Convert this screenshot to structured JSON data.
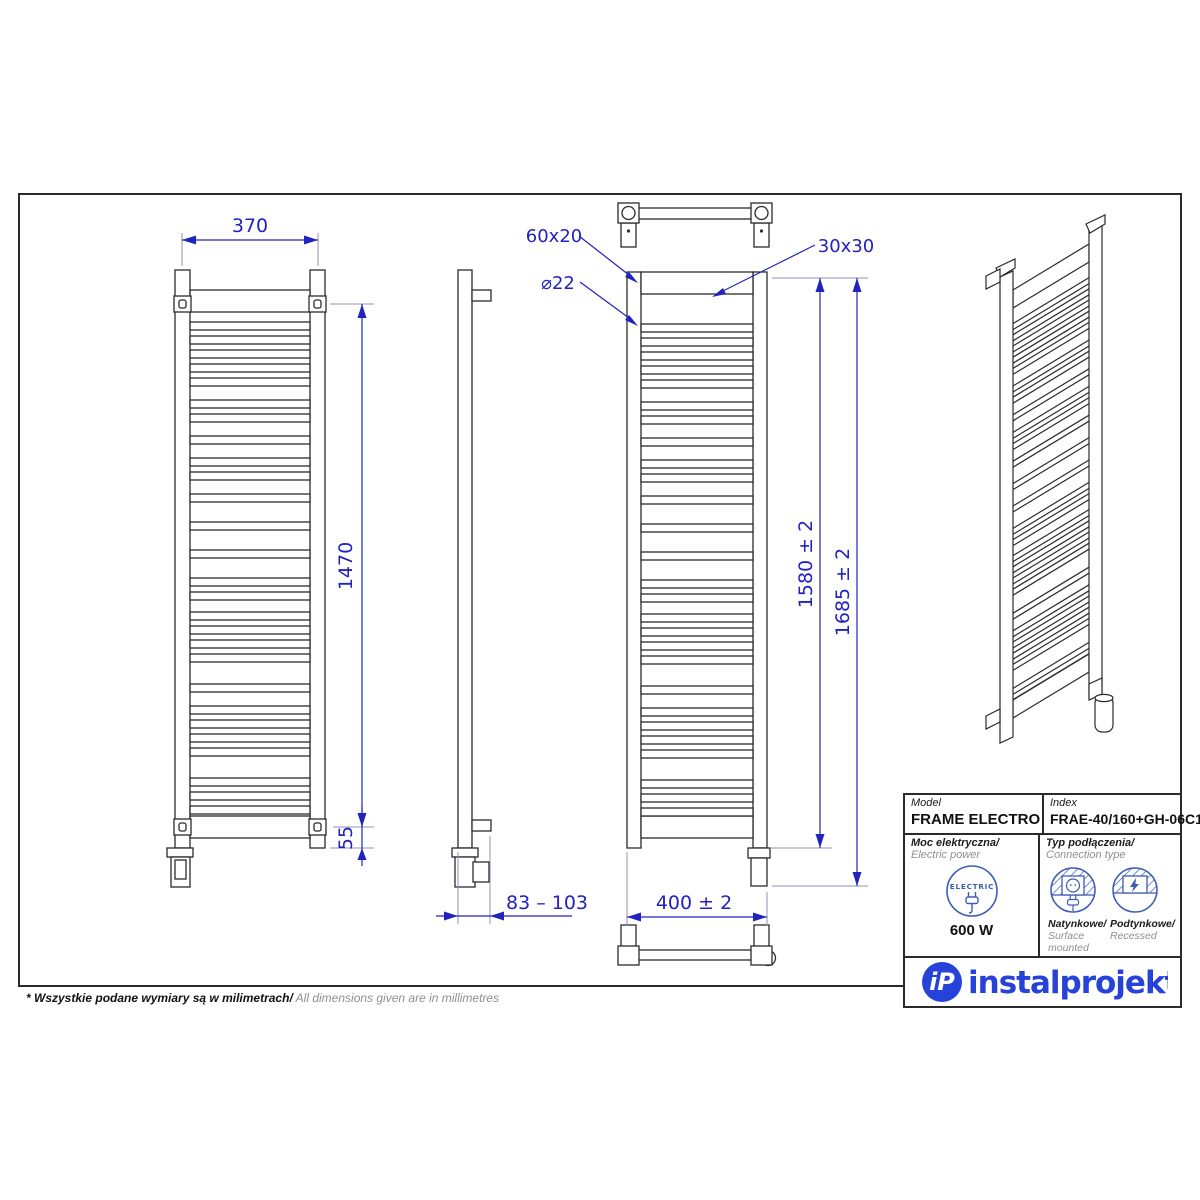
{
  "drawing": {
    "front_view": {
      "width": "370",
      "height": "1470",
      "bottom_offset": "55"
    },
    "side_view": {
      "depth_range": "83 – 103"
    },
    "connection_view": {
      "crossbar_profile": "60x20",
      "tube_diameter": "⌀22",
      "rail_profile": "30x30",
      "width": "400 ± 2",
      "height": "1580 ± 2",
      "total_height": "1685 ± 2"
    }
  },
  "table": {
    "model_label": "Model",
    "model_value": "FRAME ELECTRO",
    "index_label": "Index",
    "index_value": "FRAE-40/160+GH-06C1",
    "power_label_pl": "Moc elektryczna/",
    "power_label_en": " Electric power",
    "power_badge": "ELECTRIC",
    "power_value": "600 W",
    "connection_label_pl": "Typ podłączenia/",
    "connection_label_en": "Connection type",
    "surface_label_pl": "Natynkowe/",
    "surface_label_en": "Surface mounted",
    "recessed_label_pl": "Podtynkowe/",
    "recessed_label_en": "Recessed"
  },
  "footnote": {
    "pl": "* Wszystkie podane wymiary są w milimetrach/",
    "en": " All dimensions given are in millimetres"
  },
  "logo": {
    "monogram": "iP",
    "name": "instalprojekt"
  },
  "colors": {
    "dimension_blue": "#2222bd",
    "extension_gray": "#8f8fbe",
    "line_black": "#2b2b2b",
    "logo_blue": "#2742d8",
    "icon_blue": "#3c5cb4",
    "muted_gray": "#8f8f8f"
  }
}
